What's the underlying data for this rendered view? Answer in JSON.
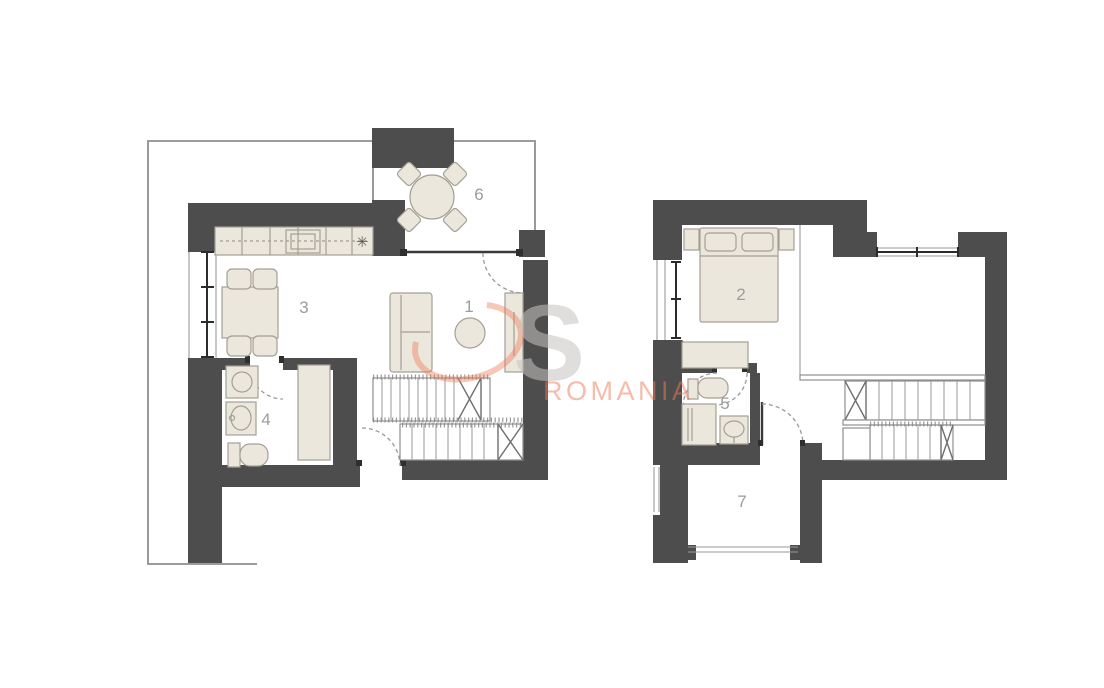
{
  "colors": {
    "background": "#ffffff",
    "wall": "#4d4d4d",
    "furniture_fill": "#ece7dd",
    "furniture_stroke": "#a59f93",
    "line": "#8f8f8f",
    "label": "#9c9c9c"
  },
  "watermark": {
    "letter": "S",
    "text": "ROMANIA",
    "accent_color": "#ef7a55",
    "gray_color": "#c6c4c0"
  },
  "ground_floor": {
    "stove_symbol": "✳",
    "rooms": [
      {
        "label": "1"
      },
      {
        "label": "3"
      },
      {
        "label": "4"
      },
      {
        "label": "6"
      }
    ]
  },
  "upper_floor": {
    "rooms": [
      {
        "label": "2"
      },
      {
        "label": "5"
      },
      {
        "label": "7"
      }
    ]
  }
}
